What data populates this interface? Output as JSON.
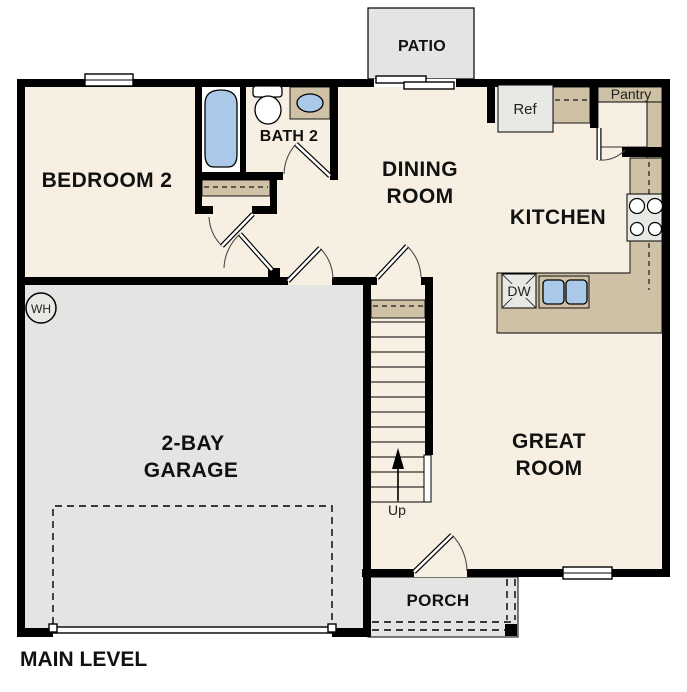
{
  "title": "MAIN LEVEL",
  "colors": {
    "floor": "#f7f0e2",
    "concrete": "#e4e4e2",
    "counter": "#cfc1a5",
    "fixture_blue": "#aac9e8",
    "wall": "#000000"
  },
  "rooms": {
    "bedroom2": {
      "label": "BEDROOM 2"
    },
    "bath2": {
      "label": "BATH 2"
    },
    "dining": {
      "line1": "DINING",
      "line2": "ROOM"
    },
    "kitchen": {
      "label": "KITCHEN"
    },
    "garage": {
      "line1": "2-BAY",
      "line2": "GARAGE"
    },
    "great_room": {
      "line1": "GREAT",
      "line2": "ROOM"
    },
    "patio": {
      "label": "PATIO"
    },
    "porch": {
      "label": "PORCH"
    },
    "pantry": {
      "label": "Pantry"
    }
  },
  "fixtures": {
    "ref": "Ref",
    "dw": "DW",
    "wh": "WH",
    "up": "Up"
  }
}
